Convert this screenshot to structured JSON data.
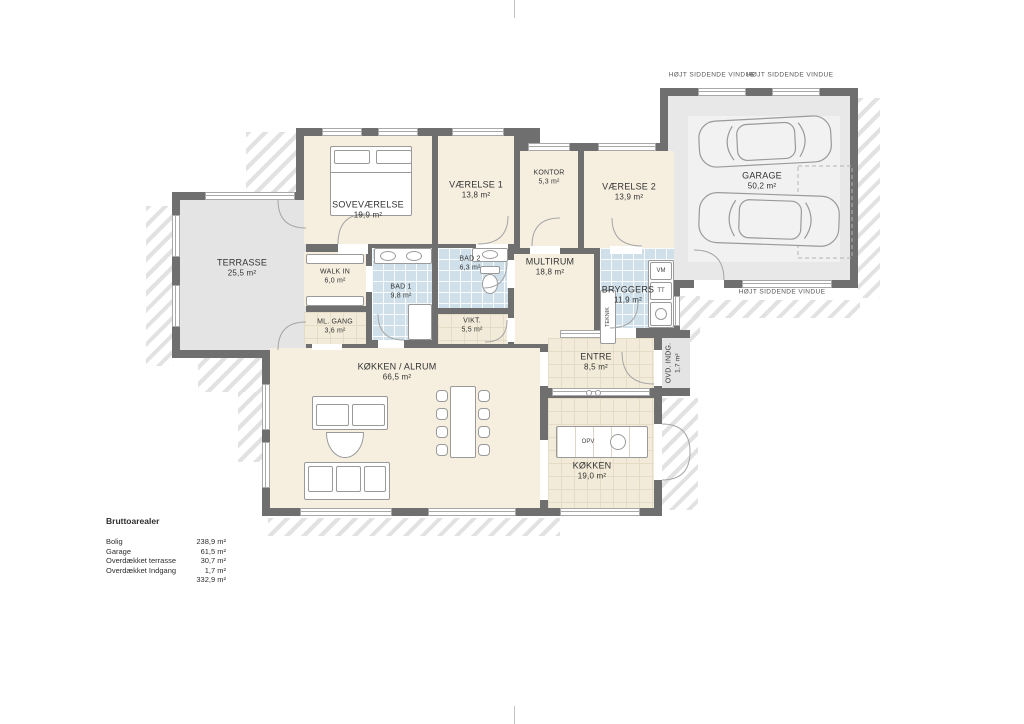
{
  "areas_table": {
    "title": "Bruttoarealer",
    "rows": [
      {
        "label": "Bolig",
        "value": "238,9 m²"
      },
      {
        "label": "Garage",
        "value": "61,5 m²"
      },
      {
        "label": "Overdækket terrasse",
        "value": "30,7 m²"
      },
      {
        "label": "Overdækket Indgang",
        "value": "1,7 m²"
      }
    ],
    "total": "332,9 m²"
  },
  "rooms": {
    "terrasse": {
      "name": "TERRASSE",
      "area": "25,5 m²"
    },
    "sovevaerelse": {
      "name": "SOVEVÆRELSE",
      "area": "19,9 m²"
    },
    "vaerelse1": {
      "name": "VÆRELSE 1",
      "area": "13,8 m²"
    },
    "kontor": {
      "name": "KONTOR",
      "area": "5,3 m²"
    },
    "vaerelse2": {
      "name": "VÆRELSE 2",
      "area": "13,9 m²"
    },
    "walkin": {
      "name": "WALK IN",
      "area": "6,0 m²"
    },
    "bad1": {
      "name": "BAD 1",
      "area": "9,8 m²"
    },
    "bad2": {
      "name": "BAD 2",
      "area": "6,3 m²"
    },
    "multirum": {
      "name": "MULTIRUM",
      "area": "18,8 m²"
    },
    "bryggers": {
      "name": "BRYGGERS",
      "area": "11,9 m²"
    },
    "mlgang": {
      "name": "ML. GANG",
      "area": "3,6 m²"
    },
    "vikt": {
      "name": "VIKT.",
      "area": "5,5 m²"
    },
    "entre": {
      "name": "ENTRE",
      "area": "8,5 m²"
    },
    "ovd_indg": {
      "name": "OVD. INDG.",
      "area": "1,7 m²"
    },
    "koekken_alrum": {
      "name": "KØKKEN / ALRUM",
      "area": "66,5 m²"
    },
    "koekken": {
      "name": "KØKKEN",
      "area": "19,0 m²"
    },
    "garage": {
      "name": "GARAGE",
      "area": "50,2 m²"
    }
  },
  "labels": {
    "hojt_siddende_vindue": "HØJT SIDDENDE VINDUE"
  },
  "appliances": {
    "vm": "VM",
    "tt": "TT",
    "opv": "OPV",
    "teknik": "TEKNIK"
  },
  "colors": {
    "wall": "#6f6f6f",
    "floor_cream": "#f6efe0",
    "floor_tile_blue": "#cfe0ea",
    "floor_gray": "#e4e4e4"
  }
}
